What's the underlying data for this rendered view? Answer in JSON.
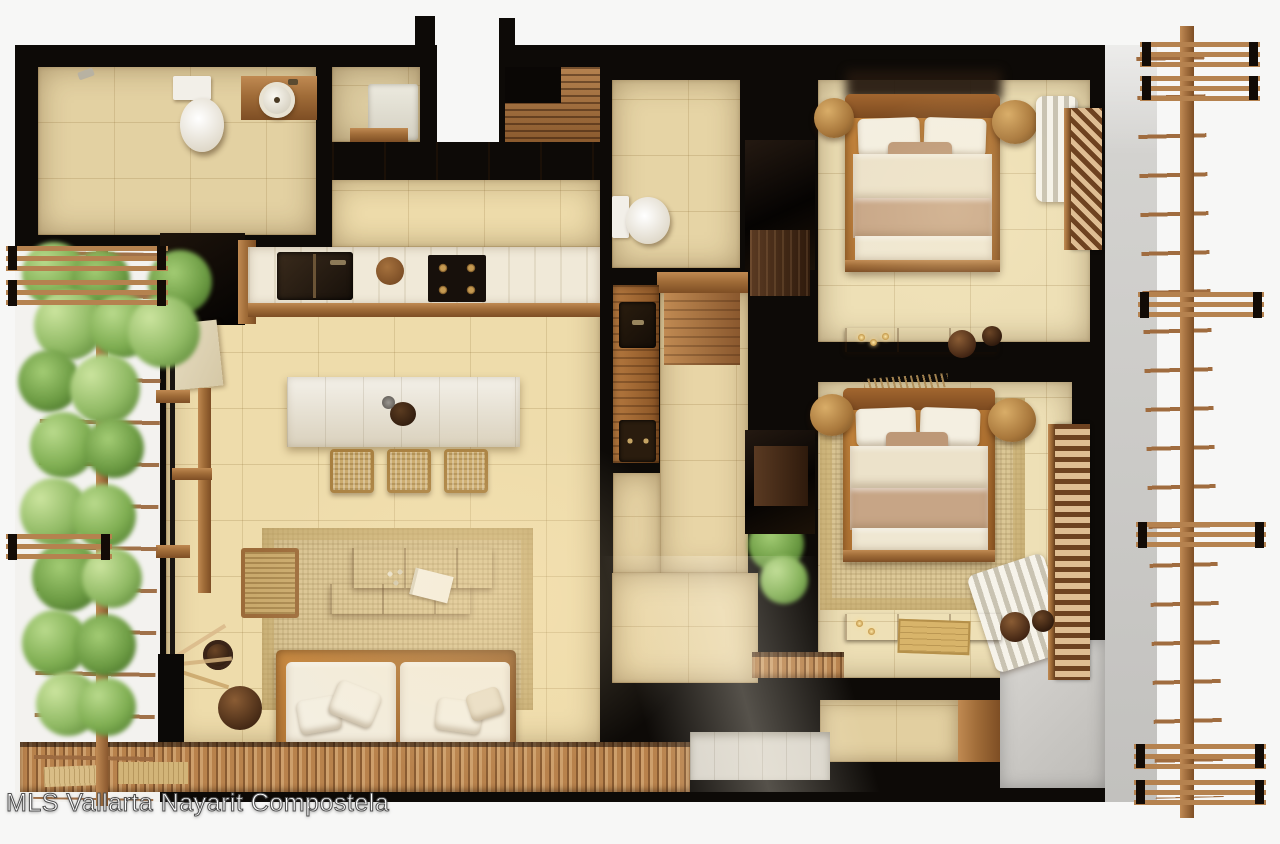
{
  "canvas": {
    "width": 1280,
    "height": 844,
    "type": "top-down 3D floor-plan render"
  },
  "watermark": {
    "text": "MLS Vallarta Nayarit Compostela"
  },
  "palette": {
    "background": "#f7f7f6",
    "wall_black": "#0d0a07",
    "floor_tile": "#eedcab",
    "bathroom_tile": "#e3d1a2",
    "bedroom_tile": "#eee0b6",
    "wood_mid": "#a06c38",
    "wood_light": "#c08a52",
    "wood_dark": "#7e4e24",
    "whitewash_island": "#e8e2d3",
    "counter_cream": "#f0e9d8",
    "linen_white": "#f2ecdd",
    "blanket_tan": "#c7a586",
    "rug_woven": "#d9c493",
    "rattan": "#b9853f",
    "plant_green": "#7fae52",
    "concrete_gray": "#cac9c6"
  },
  "legend": {
    "rooms": [
      "bathroom",
      "laundry-closet",
      "entry",
      "entry-closet",
      "kitchen",
      "island-dining",
      "living-room",
      "hall-bathroom",
      "vanity-hall",
      "bedroom-1",
      "bedroom-2",
      "terrace-alcove"
    ],
    "exterior": [
      "vertical-garden",
      "wood-trellis-left",
      "wood-trellis-right",
      "pergola-beams",
      "concrete-wall",
      "wood-deck",
      "marble-walkway"
    ],
    "furniture": [
      "toilet",
      "round-basin",
      "double-sink",
      "gas-stove",
      "kitchen-island",
      "bar-stools",
      "sofa",
      "coffee-table",
      "wicker-chair",
      "double-bed",
      "rattan-poufs",
      "curtains",
      "slatted-shutters",
      "bench-with-candles",
      "vases",
      "potted-plants"
    ]
  }
}
